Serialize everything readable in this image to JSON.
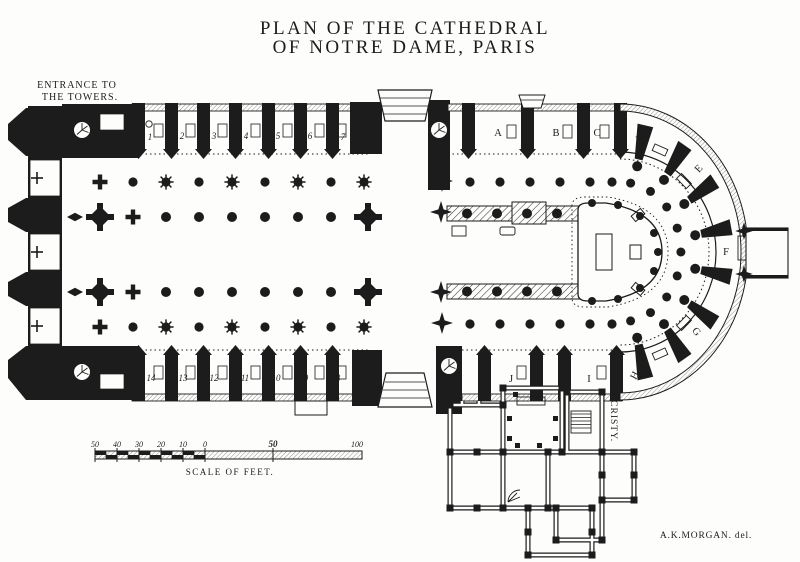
{
  "title": {
    "line1": "PLAN OF THE CATHEDRAL",
    "line2": "OF NOTRE DAME, PARIS"
  },
  "labels": {
    "entrance_line1": "ENTRANCE TO",
    "entrance_line2": "THE TOWERS.",
    "sacristy": "SACRISTY.",
    "credit": "A.K.MORGAN. del."
  },
  "chapels": {
    "nave_north": [
      "1",
      "2",
      "3",
      "4",
      "5",
      "6",
      "7"
    ],
    "nave_south": [
      "14",
      "13",
      "12",
      "11",
      "10",
      "9",
      "8"
    ],
    "choir_north": [
      "A",
      "B",
      "C",
      "D"
    ],
    "apse": [
      "E",
      "F",
      "G"
    ],
    "choir_south": [
      "J",
      "I",
      "H"
    ]
  },
  "scale_bar": {
    "ticks_left": [
      "50",
      "40",
      "30",
      "20",
      "10",
      "0"
    ],
    "mid": "50",
    "end": "100",
    "caption": "SCALE OF FEET."
  },
  "colors": {
    "ink": "#1c1c1c",
    "paper": "#fdfdfb"
  }
}
